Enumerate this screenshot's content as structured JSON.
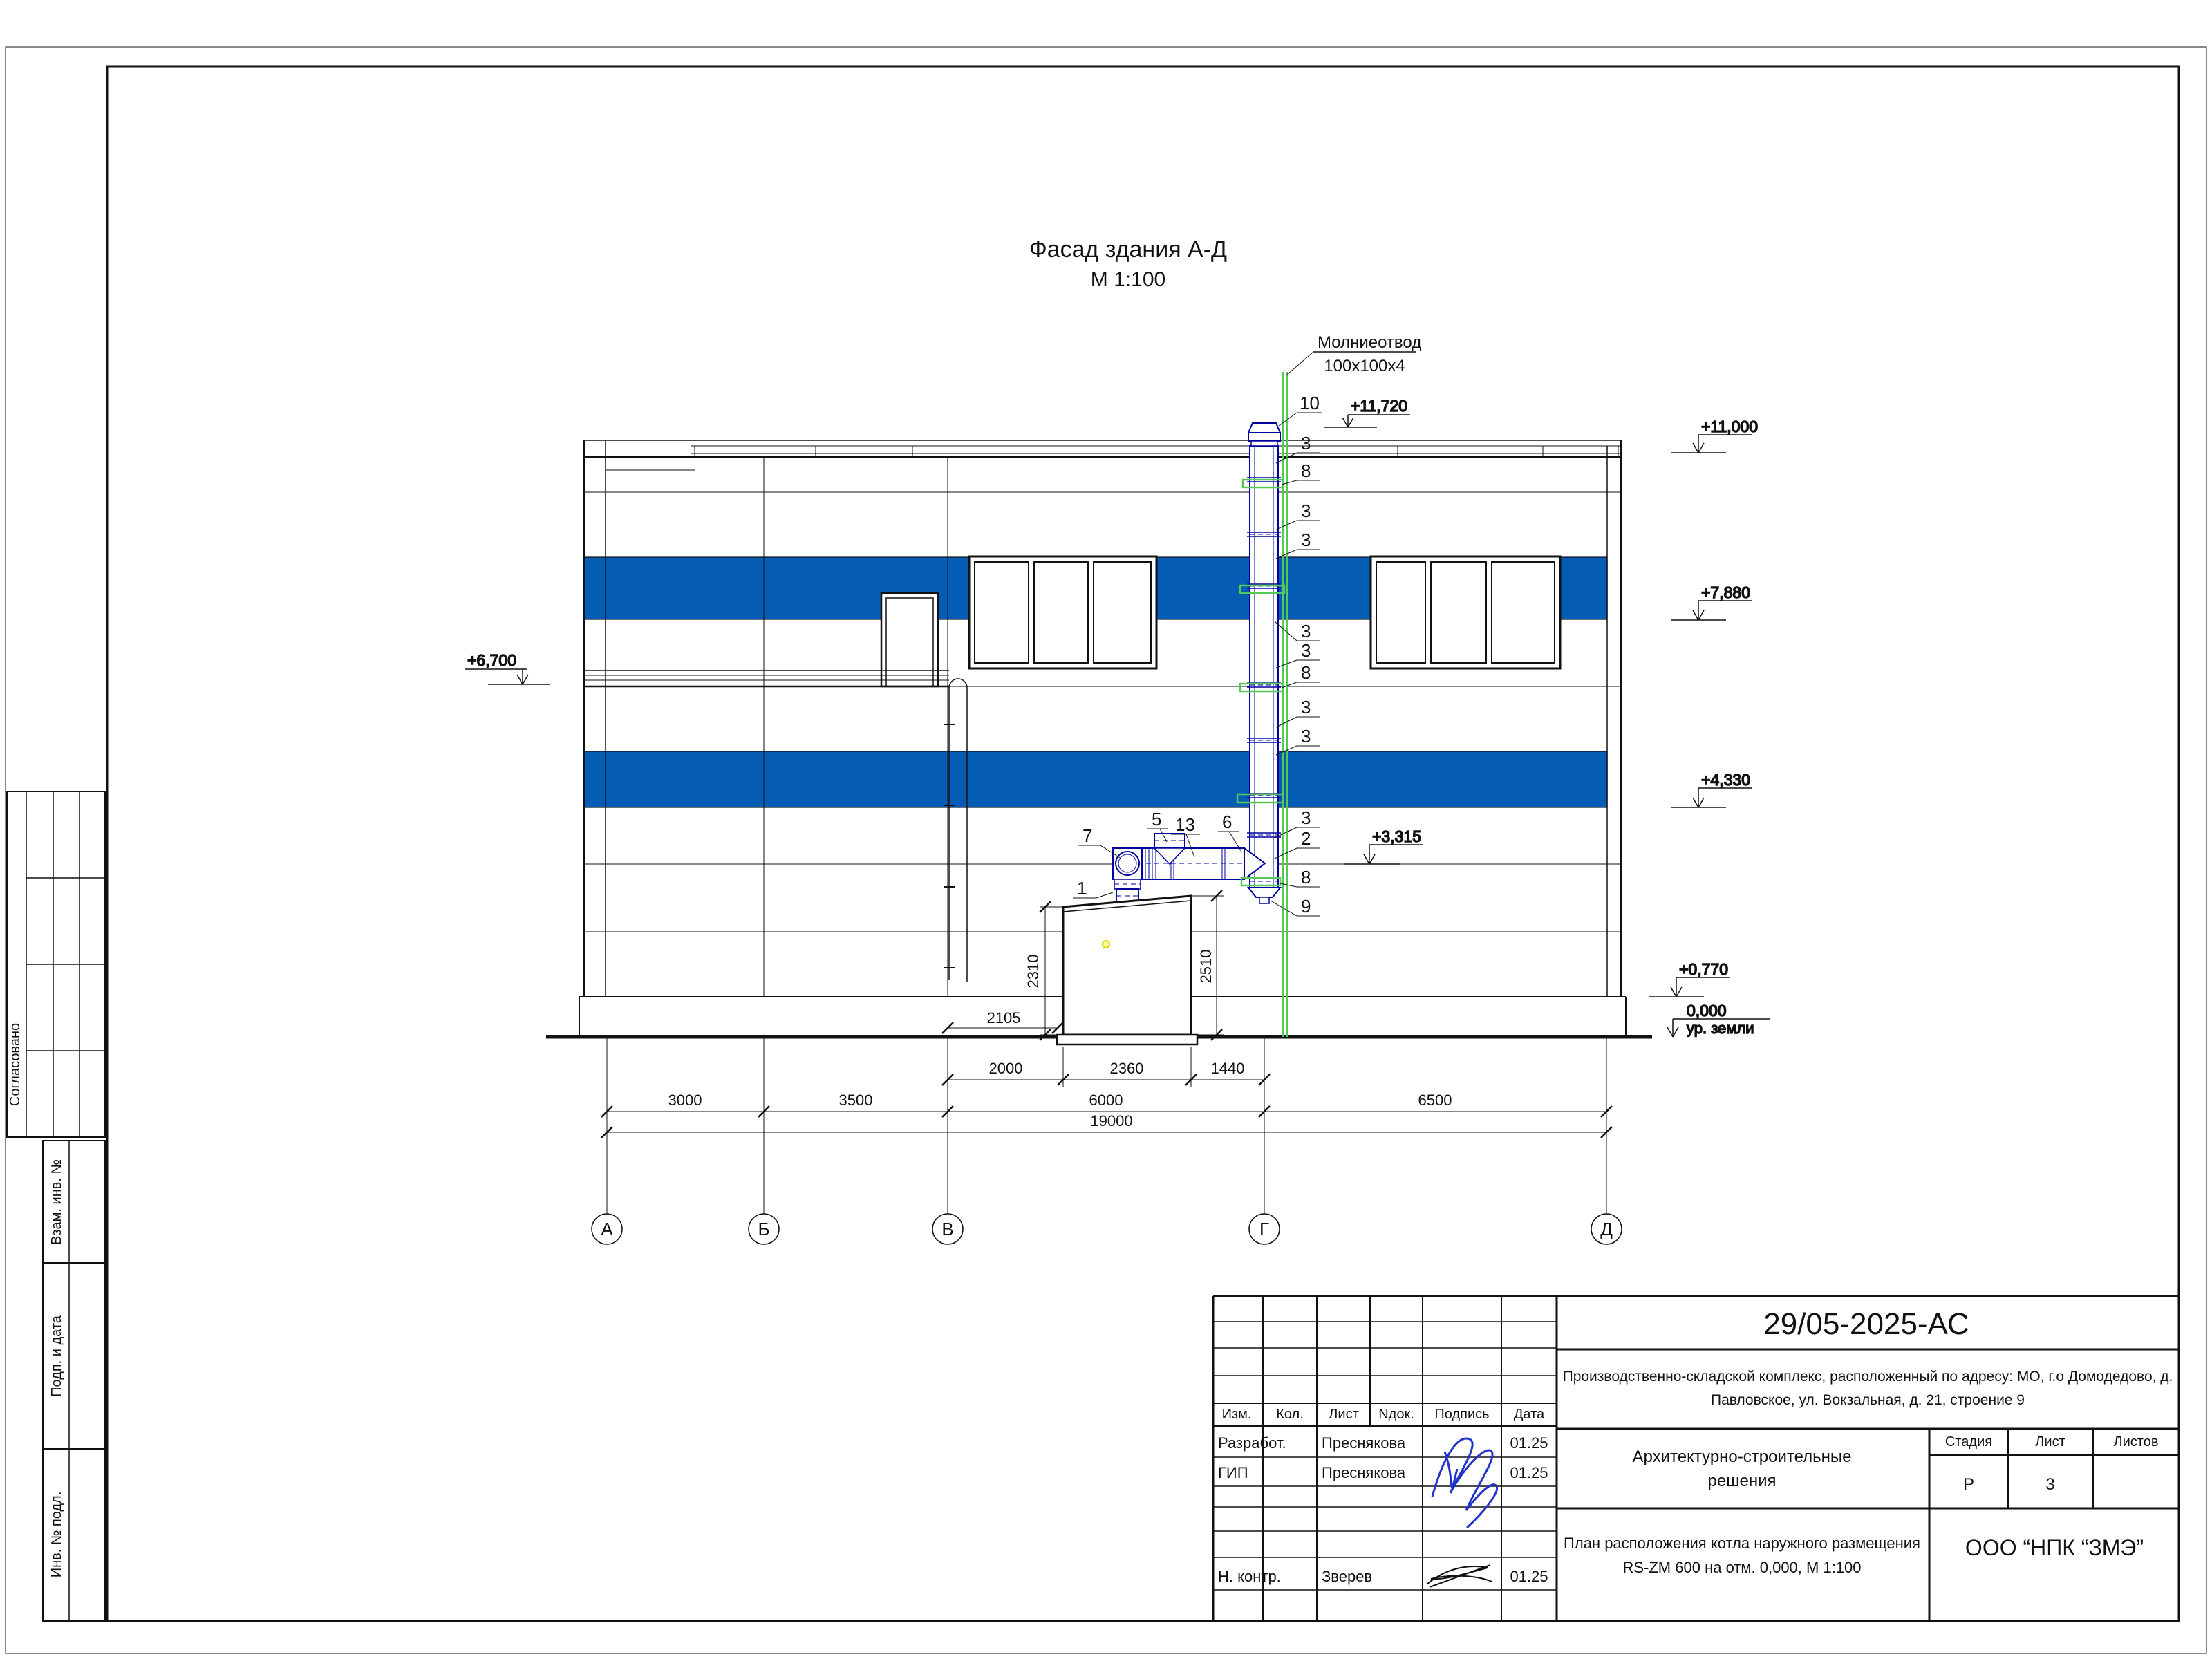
{
  "drawing": {
    "title_line1": "Фасад здания А-Д",
    "title_line2": "М 1:100",
    "lightning_label_line1": "Молниеотвод",
    "lightning_label_line2": "100х100х4",
    "ground_label": "ур. земли",
    "elevations": {
      "rod_top": "+11,720",
      "parapet": "+11,000",
      "band1": "+7,880",
      "canopy": "+6,700",
      "band2": "+4,330",
      "flue": "+3,315",
      "plinth": "+0,770",
      "zero": "0,000"
    },
    "dims": {
      "d2000": "2000",
      "d2360": "2360",
      "d1440": "1440",
      "d3000": "3000",
      "d3500": "3500",
      "d6000": "6000",
      "d6500": "6500",
      "d19000": "19000",
      "d2105": "2105",
      "d2310": "2310",
      "d2510": "2510"
    },
    "axes": [
      "А",
      "Б",
      "В",
      "Г",
      "Д"
    ],
    "callouts_right": [
      "10",
      "3",
      "8",
      "3",
      "3",
      "3",
      "3",
      "8",
      "3",
      "3",
      "3",
      "2",
      "8",
      "9"
    ],
    "callouts_left": {
      "c7": "7",
      "c5": "5",
      "c13": "13",
      "c6": "6",
      "c1": "1"
    }
  },
  "titleblock": {
    "doc_number": "29/05-2025-АС",
    "address_line1": "Производственно-складской комплекс, расположенный по адресу: МО, г.о Домодедово, д.",
    "address_line2": "Павловское, ул. Вокзальная, д. 21, строение 9",
    "section_title_line1": "Архитектурно-строительные",
    "section_title_line2": "решения",
    "sheet_title_line1": "План расположения котла наружного размещения",
    "sheet_title_line2": "RS-ZM 600 на отм. 0,000,  М 1:100",
    "company": "ООО “НПК “ЗМЭ”",
    "headers": {
      "izm": "Изм.",
      "kol": "Кол.",
      "list": "Лист",
      "ndok": "Nдок.",
      "podpis": "Подпись",
      "data": "Дата",
      "stadia": "Стадия",
      "list2": "Лист",
      "listov": "Листов"
    },
    "stadia_value": "Р",
    "list_value": "3",
    "rows": [
      {
        "role": "Разработ.",
        "name": "Преснякова",
        "date": "01.25"
      },
      {
        "role": "ГИП",
        "name": "Преснякова",
        "date": "01.25"
      },
      {
        "role": "Н. контр.",
        "name": "Зверев",
        "date": "01.25"
      }
    ]
  },
  "stamps": {
    "soglasovano": "Согласовано",
    "vzam": "Взам. инв. №",
    "podp": "Подп. и дата",
    "inv": "Инв. № подл."
  },
  "colors": {
    "band_blue": "#045CB5",
    "flue_blue": "#0000A0",
    "rod_green": "#57C857",
    "signature_blue": "#2233CC",
    "dot_yellow": "#E8E800"
  }
}
